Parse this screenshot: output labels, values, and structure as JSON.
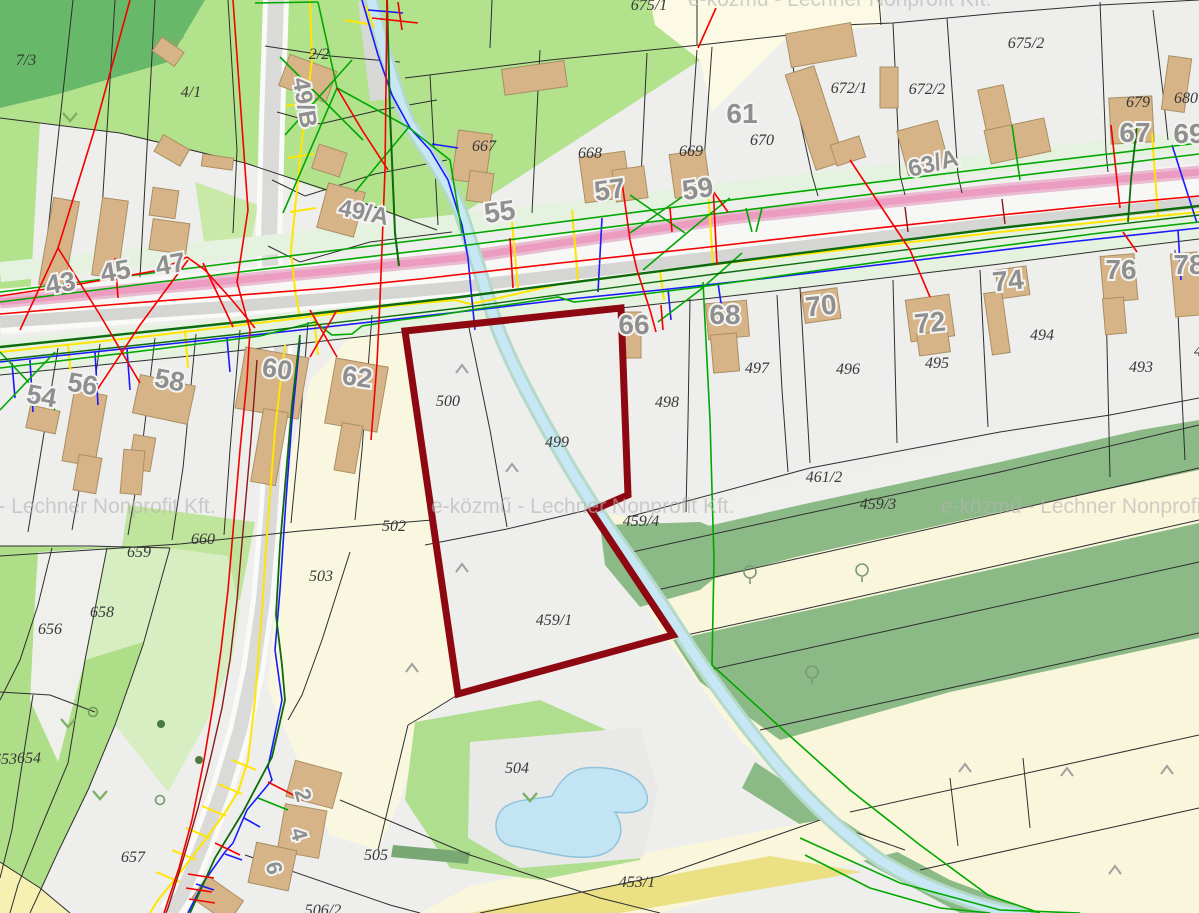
{
  "map": {
    "watermark_text": "e-közmű - Lechner Nonprofit Kft.",
    "colors": {
      "selected_outline": "#8e0812",
      "road_pink": "#ec9cc0",
      "water": "#c2e4f3",
      "building": "#d6b488",
      "forest_green": "#8cba86",
      "meadow_green": "#aede87",
      "utility_red": "#f40000",
      "utility_green": "#00a800",
      "utility_dark_green": "#0c6b0c",
      "utility_blue": "#1a1aff",
      "utility_yellow": "#ffe500",
      "utility_maroon": "#8b1a1a"
    },
    "labels": {
      "houses": [
        {
          "t": "43",
          "x": 62,
          "y": 283,
          "r": -10,
          "s": 27
        },
        {
          "t": "45",
          "x": 117,
          "y": 271,
          "r": -10,
          "s": 27
        },
        {
          "t": "47",
          "x": 172,
          "y": 264,
          "r": -10,
          "s": 27
        },
        {
          "t": "49/B",
          "x": 297,
          "y": 95,
          "r": 80,
          "s": 24
        },
        {
          "t": "49/A",
          "x": 362,
          "y": 211,
          "r": 12,
          "s": 24
        },
        {
          "t": "54",
          "x": 40,
          "y": 396,
          "r": 10,
          "s": 27
        },
        {
          "t": "56",
          "x": 81,
          "y": 384,
          "r": 10,
          "s": 27
        },
        {
          "t": "58",
          "x": 168,
          "y": 380,
          "r": 10,
          "s": 27
        },
        {
          "t": "60",
          "x": 276,
          "y": 369,
          "r": 8,
          "s": 27
        },
        {
          "t": "62",
          "x": 356,
          "y": 377,
          "r": 8,
          "s": 27
        },
        {
          "t": "55",
          "x": 501,
          "y": 212,
          "r": -8,
          "s": 28
        },
        {
          "t": "57",
          "x": 611,
          "y": 190,
          "r": -8,
          "s": 28
        },
        {
          "t": "59",
          "x": 699,
          "y": 189,
          "r": -8,
          "s": 28
        },
        {
          "t": "61",
          "x": 742,
          "y": 114,
          "r": 0,
          "s": 28
        },
        {
          "t": "63/A",
          "x": 935,
          "y": 162,
          "r": -14,
          "s": 24
        },
        {
          "t": "66",
          "x": 634,
          "y": 325,
          "r": 0,
          "s": 28
        },
        {
          "t": "67",
          "x": 1135,
          "y": 133,
          "r": 0,
          "s": 28
        },
        {
          "t": "68",
          "x": 725,
          "y": 315,
          "r": 0,
          "s": 28
        },
        {
          "t": "69",
          "x": 1189,
          "y": 134,
          "r": 0,
          "s": 28
        },
        {
          "t": "70",
          "x": 822,
          "y": 306,
          "r": -6,
          "s": 28
        },
        {
          "t": "72",
          "x": 931,
          "y": 323,
          "r": -6,
          "s": 28
        },
        {
          "t": "74",
          "x": 1009,
          "y": 281,
          "r": -6,
          "s": 28
        },
        {
          "t": "76",
          "x": 1121,
          "y": 270,
          "r": 0,
          "s": 28
        },
        {
          "t": "78",
          "x": 1189,
          "y": 265,
          "r": 0,
          "s": 28
        },
        {
          "t": "2",
          "x": 296,
          "y": 788,
          "r": 75,
          "s": 22
        },
        {
          "t": "4",
          "x": 292,
          "y": 827,
          "r": 75,
          "s": 22
        },
        {
          "t": "6",
          "x": 267,
          "y": 861,
          "r": 75,
          "s": 22
        }
      ],
      "parcels": [
        {
          "t": "7/3",
          "x": 26,
          "y": 60
        },
        {
          "t": "4/1",
          "x": 191,
          "y": 92
        },
        {
          "t": "2/2",
          "x": 319,
          "y": 54
        },
        {
          "t": "675/1",
          "x": 649,
          "y": 5
        },
        {
          "t": "675/2",
          "x": 1026,
          "y": 43
        },
        {
          "t": "672/1",
          "x": 849,
          "y": 88
        },
        {
          "t": "672/2",
          "x": 927,
          "y": 89
        },
        {
          "t": "679",
          "x": 1138,
          "y": 102
        },
        {
          "t": "680",
          "x": 1186,
          "y": 98
        },
        {
          "t": "667",
          "x": 484,
          "y": 146
        },
        {
          "t": "668",
          "x": 590,
          "y": 153
        },
        {
          "t": "669",
          "x": 691,
          "y": 151
        },
        {
          "t": "670",
          "x": 762,
          "y": 140
        },
        {
          "t": "494",
          "x": 1042,
          "y": 335
        },
        {
          "t": "495",
          "x": 937,
          "y": 363
        },
        {
          "t": "496",
          "x": 848,
          "y": 369
        },
        {
          "t": "497",
          "x": 757,
          "y": 368
        },
        {
          "t": "498",
          "x": 667,
          "y": 402
        },
        {
          "t": "493",
          "x": 1141,
          "y": 367
        },
        {
          "t": "492",
          "x": 1206,
          "y": 351
        },
        {
          "t": "500",
          "x": 448,
          "y": 401
        },
        {
          "t": "499",
          "x": 557,
          "y": 442
        },
        {
          "t": "502",
          "x": 394,
          "y": 526
        },
        {
          "t": "503",
          "x": 321,
          "y": 576
        },
        {
          "t": "459/4",
          "x": 641,
          "y": 521
        },
        {
          "t": "461/2",
          "x": 824,
          "y": 477
        },
        {
          "t": "459/3",
          "x": 878,
          "y": 504
        },
        {
          "t": "459/1",
          "x": 554,
          "y": 620
        },
        {
          "t": "504",
          "x": 517,
          "y": 768
        },
        {
          "t": "505",
          "x": 376,
          "y": 855
        },
        {
          "t": "506/2",
          "x": 323,
          "y": 910
        },
        {
          "t": "453/1",
          "x": 637,
          "y": 882
        },
        {
          "t": "657",
          "x": 133,
          "y": 857
        },
        {
          "t": "656",
          "x": 50,
          "y": 629
        },
        {
          "t": "658",
          "x": 102,
          "y": 612
        },
        {
          "t": "659",
          "x": 139,
          "y": 552
        },
        {
          "t": "654",
          "x": 29,
          "y": 758
        },
        {
          "t": "653",
          "x": 5,
          "y": 759
        },
        {
          "t": "660",
          "x": 203,
          "y": 539
        }
      ]
    },
    "watermarks": [
      {
        "x": -88,
        "y": 513
      },
      {
        "x": 431,
        "y": 513
      },
      {
        "x": 941,
        "y": 513
      },
      {
        "x": 688,
        "y": 6
      }
    ]
  }
}
